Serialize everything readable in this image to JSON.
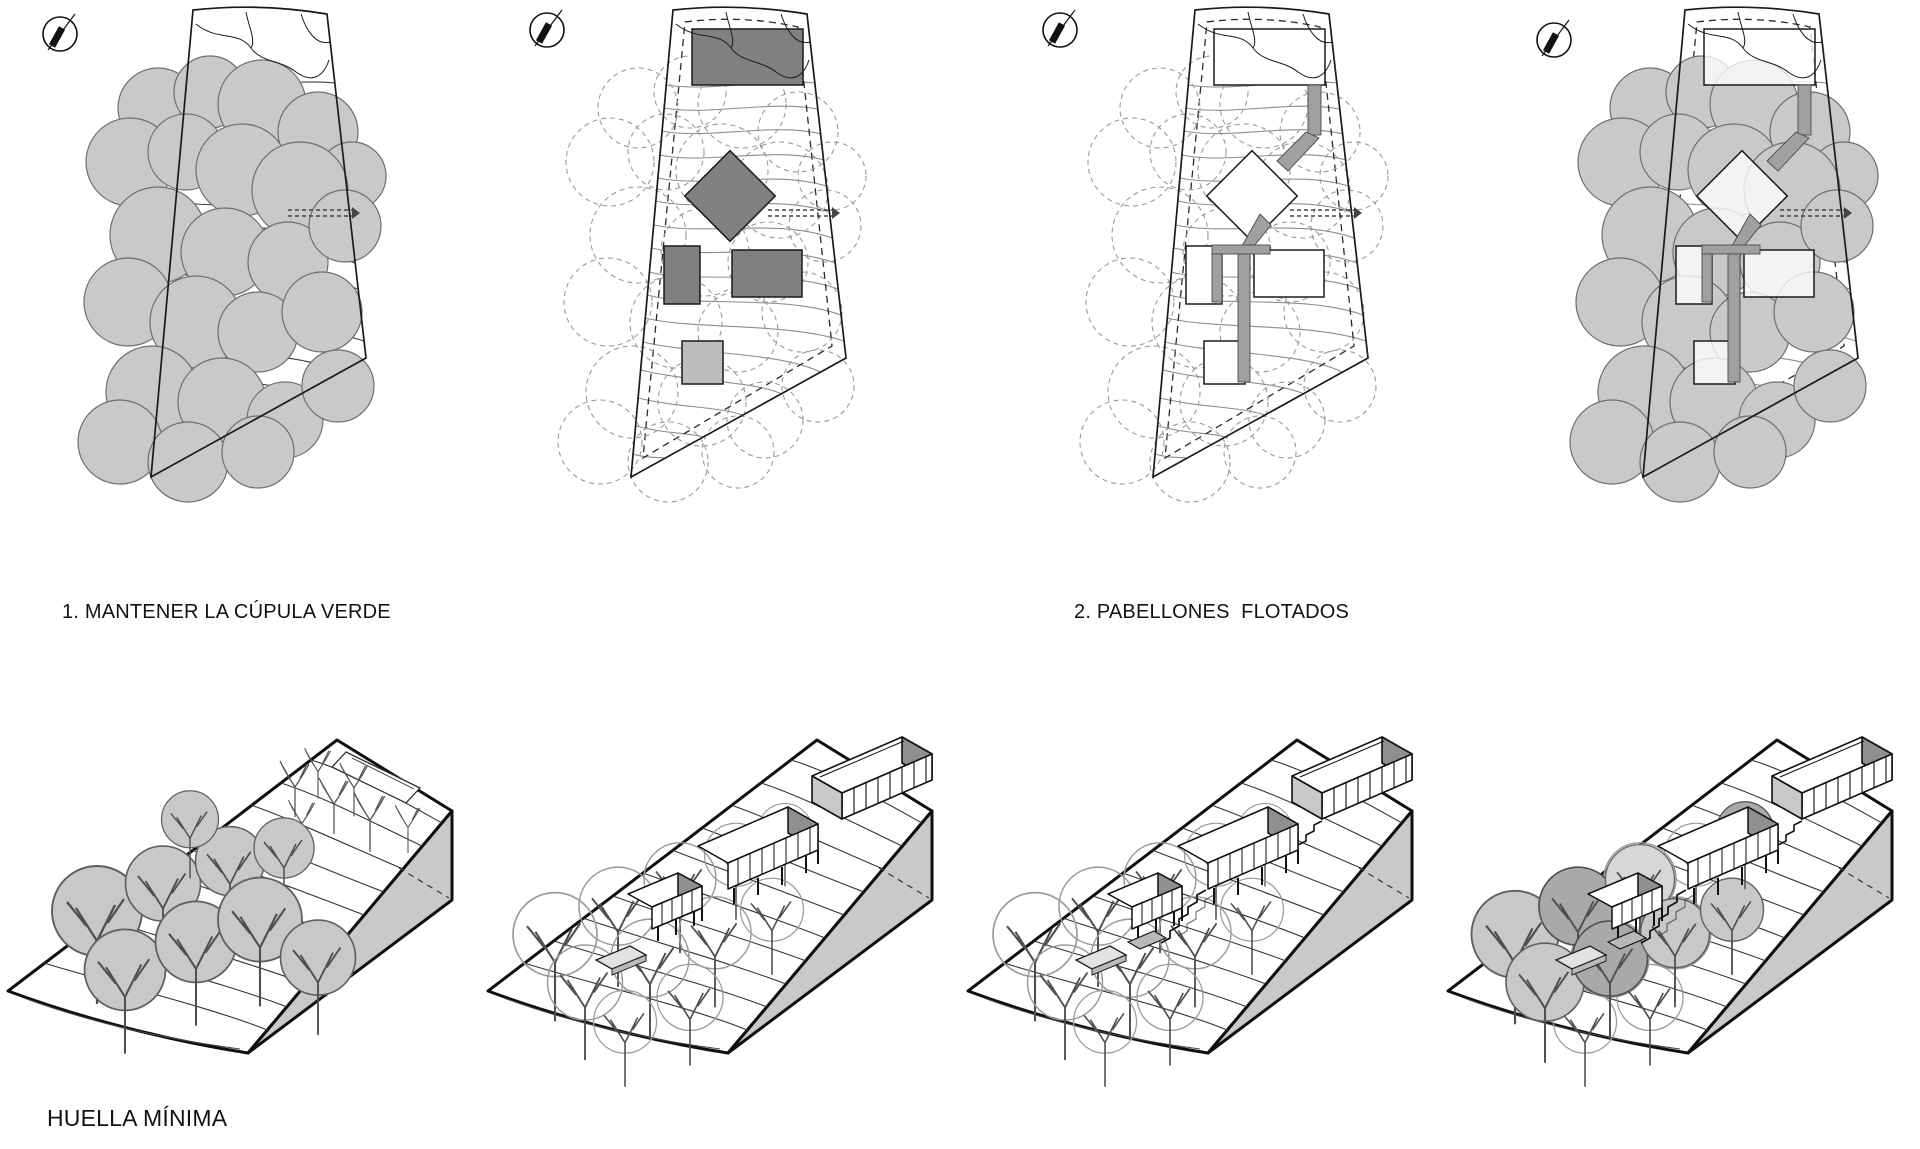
{
  "sheet": {
    "title": "architectural concept diagram sheet",
    "background": "#ffffff"
  },
  "panels": [
    {
      "number": "1",
      "label": "1. MANTENER LA CÚPULA VERDE"
    },
    {
      "number": "2",
      "label": "2. PABELLONES  FLOTADOS"
    },
    {
      "number": "3",
      "label": "3. CONEXIONES SUTILES"
    },
    {
      "number": "4",
      "label": "4. SIMBIOSIS CON LA NATURALEZA"
    }
  ],
  "footer": {
    "caption": "HUELLA MÍNIMA"
  },
  "icons": {
    "north_arrow": "north-arrow compass with diagonal needle"
  },
  "colors": {
    "line": "#1a1a1a",
    "tree_fill": "#c9c9c9",
    "tree_dark": "#a9a9a9",
    "building_gray": "#808080",
    "building_light": "#bdbdbd",
    "connector_gray": "#a0a0a0",
    "terrain_face": "#c9c9c9",
    "dashed_tree": "#9a9a9a",
    "background": "#ffffff"
  }
}
